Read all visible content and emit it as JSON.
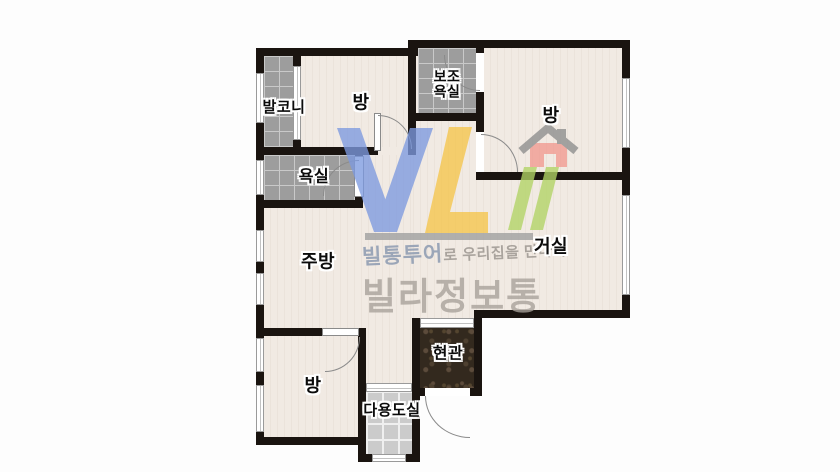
{
  "title": "villa-floorplan",
  "rooms": {
    "balcony": "발코니",
    "room_top_left": "방",
    "aux_bath_l1": "보조",
    "aux_bath_l2": "욕실",
    "room_top_right": "방",
    "bath": "욕실",
    "kitchen": "주방",
    "living": "거실",
    "room_bottom": "방",
    "entrance": "현관",
    "utility": "다용도실"
  },
  "watermark": {
    "tagline_brand": "빌통투어",
    "tagline_rest": "로 우리집을 만나다",
    "brand": "빌라정보통",
    "colors": {
      "v_blue": "#7d9ae0",
      "l_yellow": "#f5c54b",
      "i_green": "#b2d465",
      "house_pink": "#f19a90",
      "roof_gray": "#8d8d8d",
      "bar_gray": "#9f9f9f",
      "tagline_brand": "#8494ad",
      "tagline_rest": "#96908a",
      "brand_gray": "#a7a19a"
    }
  },
  "colors": {
    "wall": "#1a1410",
    "floor": "#f1eae3",
    "tile_base": "#9d9d9d",
    "tile_line": "#c9c9c9",
    "tile_light_base": "#cbcbcb",
    "tile_light_line": "#efefef",
    "marble": "#33291e",
    "door_line": "#8a8a8a",
    "window_border": "#9a9a9a"
  }
}
